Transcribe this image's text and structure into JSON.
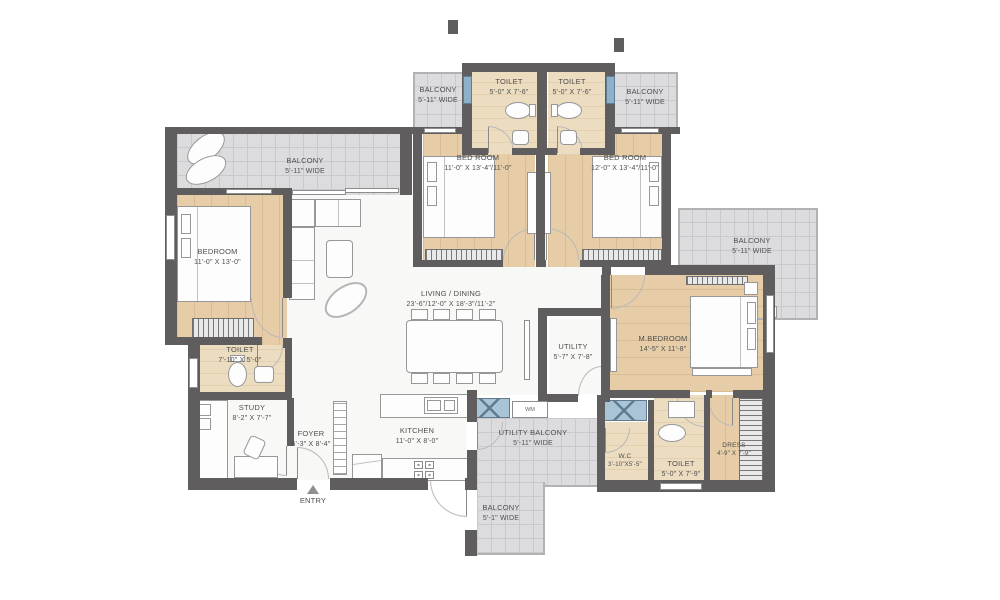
{
  "title": "apartment-floor-plan",
  "rooms": {
    "balcony_top_left": {
      "name": "BALCONY",
      "dims": "5'-11\" WIDE"
    },
    "toilet_top_1": {
      "name": "TOILET",
      "dims": "5'-0\" X 7'-6\""
    },
    "toilet_top_2": {
      "name": "TOILET",
      "dims": "5'-0\" X 7'-6\""
    },
    "balcony_top_right": {
      "name": "BALCONY",
      "dims": "5'-11\" WIDE"
    },
    "balcony_left": {
      "name": "BALCONY",
      "dims": "5'-11\" WIDE"
    },
    "bedroom_2": {
      "name": "BED ROOM",
      "dims": "11'-0\" X 13'-4\"/11'-0\""
    },
    "bedroom_3": {
      "name": "BED ROOM",
      "dims": "12'-0\" X 13'-4\"/11'-0\""
    },
    "bedroom_1": {
      "name": "BEDROOM",
      "dims": "11'-0\" X 13'-0\""
    },
    "living_dining": {
      "name": "LIVING / DINING",
      "dims": "23'-6\"/12'-0\" X 18'-3\"/11'-2\""
    },
    "balcony_right": {
      "name": "BALCONY",
      "dims": "5'-11\" WIDE"
    },
    "toilet_left": {
      "name": "TOILET",
      "dims": "7'-10\" X 5'-0\""
    },
    "study": {
      "name": "STUDY",
      "dims": "8'-2\" X 7'-7\""
    },
    "foyer": {
      "name": "FOYER",
      "dims": "5'-3\" X 8'-4\""
    },
    "kitchen": {
      "name": "KITCHEN",
      "dims": "11'-0\" X 8'-0\""
    },
    "utility": {
      "name": "UTILITY",
      "dims": "5'-7\" X 7'-8\""
    },
    "utility_balcony": {
      "name": "UTILITY BALCONY",
      "dims": "5'-11\" WIDE"
    },
    "m_bedroom": {
      "name": "M.BEDROOM",
      "dims": "14'-5\" X 11'-8\""
    },
    "wc": {
      "name": "W.C",
      "dims": "3'-10\"X5'-5\""
    },
    "toilet_master": {
      "name": "TOILET",
      "dims": "5'-0\" X 7'-9\""
    },
    "dress": {
      "name": "DRESS",
      "dims": "4'-9\" X 7'-9\""
    },
    "balcony_bottom": {
      "name": "BALCONY",
      "dims": "5'-1\" WIDE"
    }
  },
  "markers": {
    "entry": "ENTRY",
    "washing_machine": "WM"
  },
  "colors": {
    "wall": "#5f5d5d",
    "wood_floor": "#e6cda7",
    "tile_floor": "#dcdcde",
    "bath_floor": "#ecdcc0",
    "window_blue": "#8fb0c9"
  }
}
